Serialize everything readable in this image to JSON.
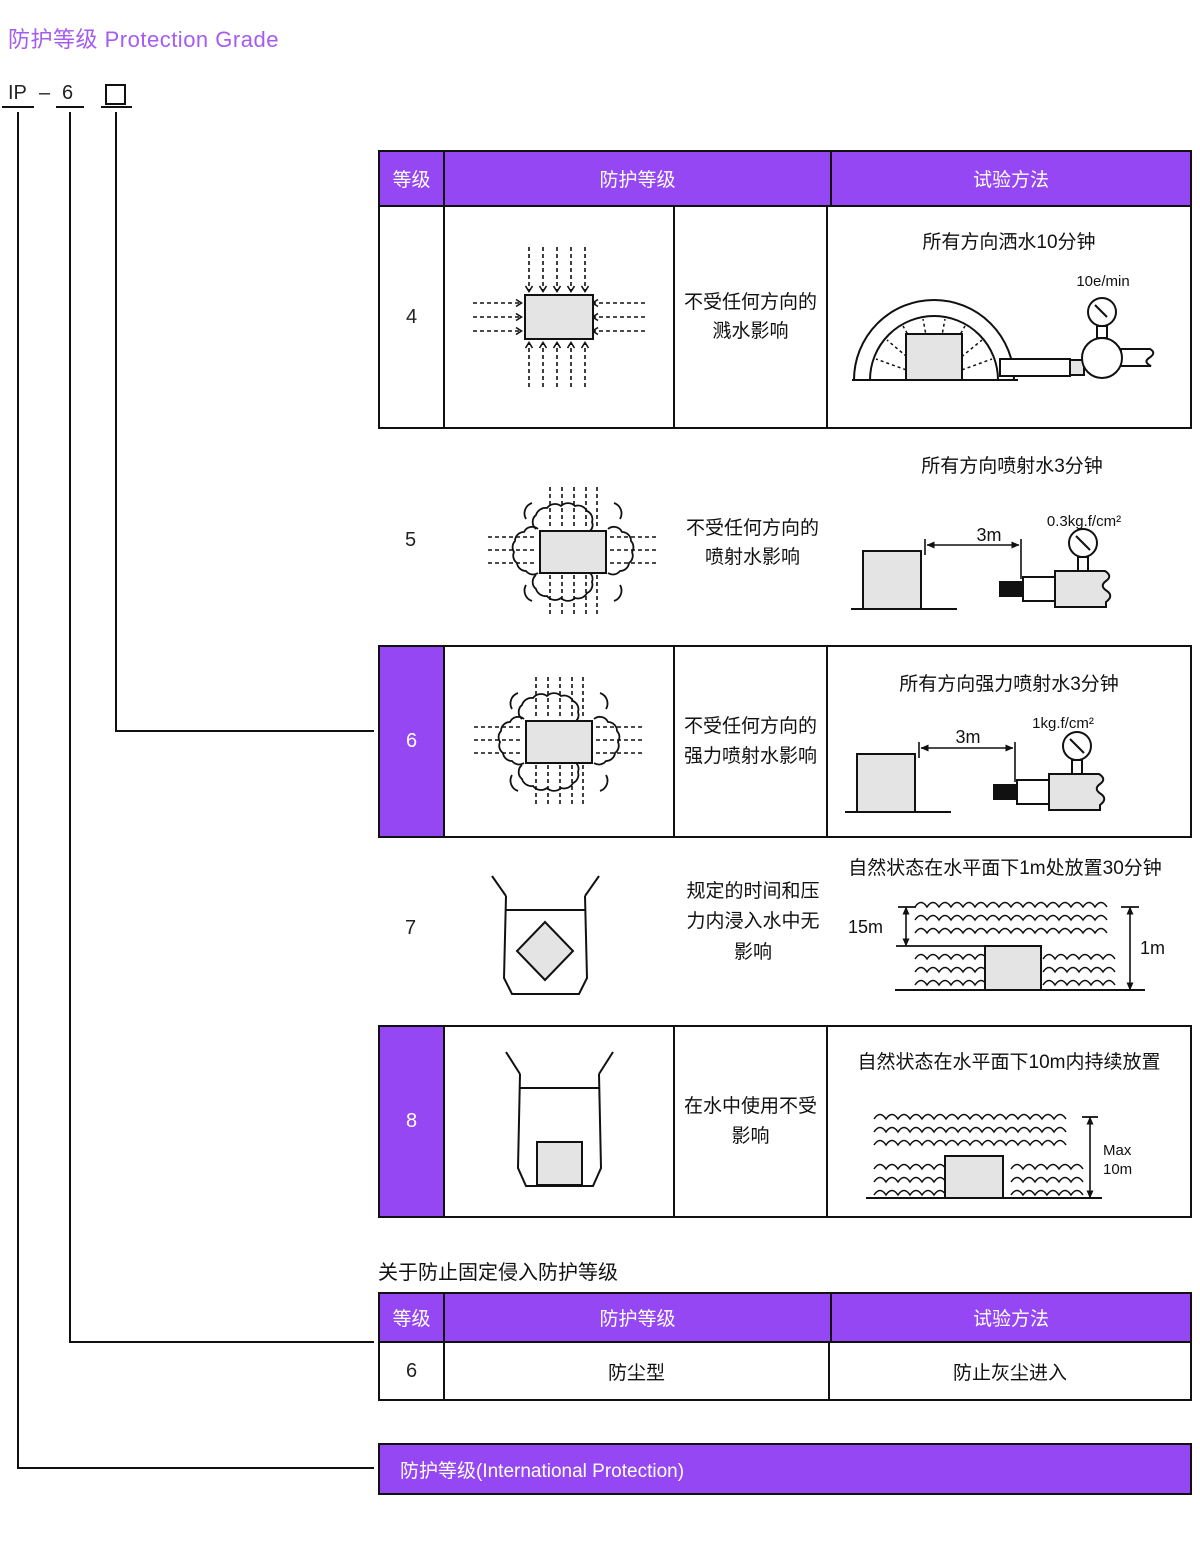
{
  "title": "防护等级 Protection Grade",
  "ip_code": {
    "prefix": "IP",
    "separator": "–",
    "digit": "6"
  },
  "colors": {
    "purple": "#9447f2",
    "title_purple": "#a55cf2",
    "line": "#111111",
    "shape_gray": "#e4e4e4"
  },
  "water_table": {
    "headers": {
      "grade": "等级",
      "protection": "防护等级",
      "test": "试验方法"
    },
    "rows": [
      {
        "grade": "4",
        "highlight": false,
        "protection": "不受任何方向的\n溅水影响",
        "test_title": "所有方向洒水10分钟",
        "flow_label": "10e/min"
      },
      {
        "grade": "5",
        "highlight": false,
        "protection": "不受任何方向的\n喷射水影响",
        "test_title": "所有方向喷射水3分钟",
        "distance_label": "3m",
        "pressure_label": "0.3kg.f/cm²"
      },
      {
        "grade": "6",
        "highlight": true,
        "protection": "不受任何方向的\n强力喷射水影响",
        "test_title": "所有方向强力喷射水3分钟",
        "distance_label": "3m",
        "pressure_label": "1kg.f/cm²"
      },
      {
        "grade": "7",
        "highlight": false,
        "protection": "规定的时间和压\n力内浸入水中无\n影响",
        "test_title": "自然状态在水平面下1m处放置30分钟",
        "depth_label": "15m",
        "total_depth_label": "1m"
      },
      {
        "grade": "8",
        "highlight": true,
        "protection": "在水中使用不受\n影响",
        "test_title": "自然状态在水平面下10m内持续放置",
        "max_depth_label": "Max\n10m"
      }
    ]
  },
  "dust_table": {
    "caption": "关于防止固定侵入防护等级",
    "headers": {
      "grade": "等级",
      "protection": "防护等级",
      "test": "试验方法"
    },
    "rows": [
      {
        "grade": "6",
        "protection": "防尘型",
        "test": "防止灰尘进入"
      }
    ]
  },
  "footer_bar": {
    "label": "防护等级(International Protection)"
  }
}
